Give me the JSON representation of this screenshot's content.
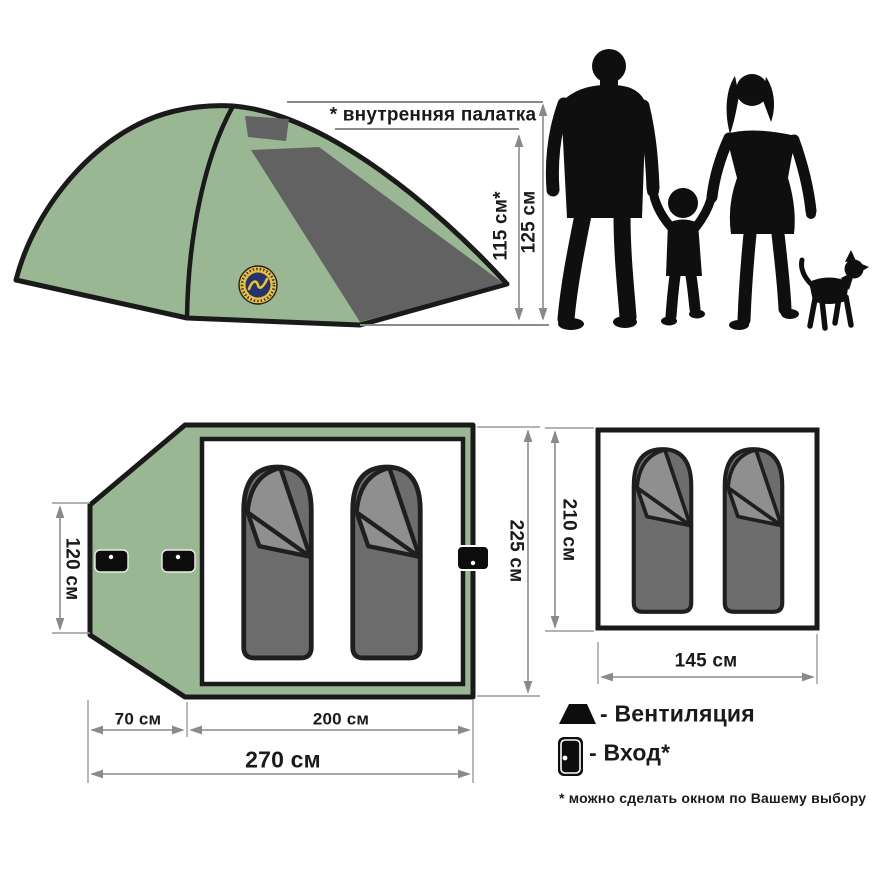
{
  "side_view": {
    "inner_tent_note": "* внутренняя палатка",
    "inner_height": "115 см*",
    "outer_height": "125 см"
  },
  "floor_plan": {
    "vestibule_height": "120 см",
    "inner_width": "225 см",
    "vestibule_length": "70 см",
    "room_length": "200 см",
    "total_length": "270 см"
  },
  "inner_tent_plan": {
    "height": "210 см",
    "width": "145 см"
  },
  "legend": {
    "ventilation_label": "- Вентиляция",
    "entrance_label": "- Вход*",
    "footnote": "* можно сделать окном по Вашему выбору"
  },
  "icons": {
    "ventilation": "trapezoid-vent-icon",
    "entrance": "door-with-handle-icon",
    "brand_logo": "round-yellow-navy-badge"
  },
  "colors": {
    "tent_green": "#9ab794",
    "panel_gray": "#626262",
    "bag_gray": "#6d6d6d",
    "bag_flap_gray": "#8f8f8f",
    "silhouette_black": "#0f0f0f",
    "dimension_gray": "#8a8a8a",
    "logo_yellow": "#eec02c",
    "logo_navy": "#233270"
  }
}
